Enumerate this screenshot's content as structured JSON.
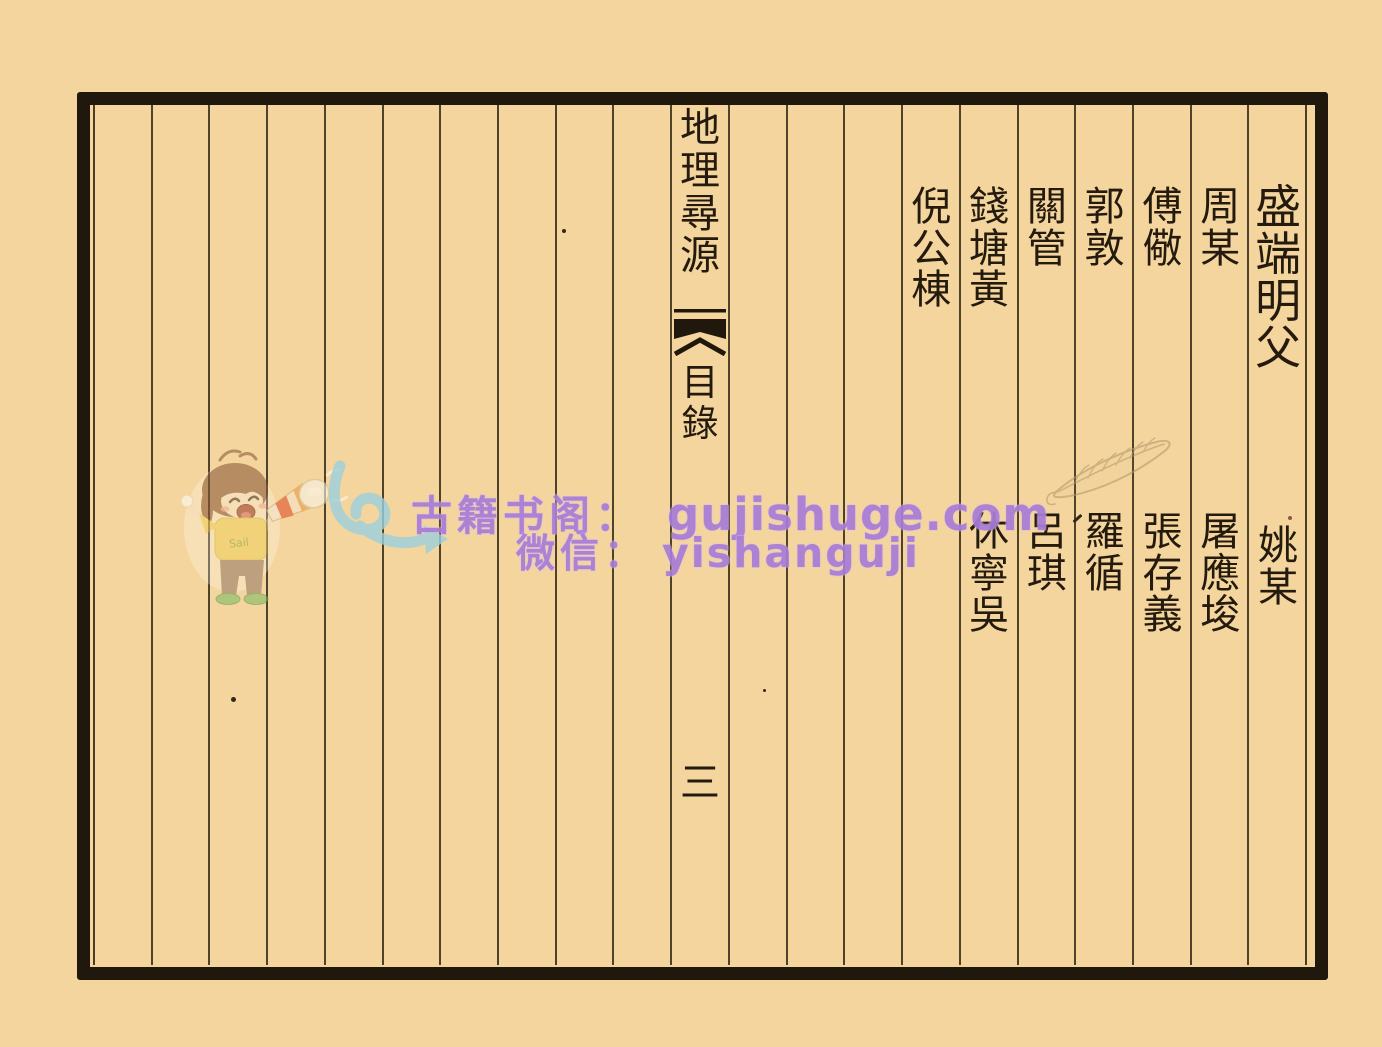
{
  "page_scan": {
    "background_color": "#f4d59d",
    "ink_color": "#241b0e",
    "total_columns": 21,
    "spine": {
      "title": "地理尋源",
      "section_label": "目錄",
      "page_number": "三"
    },
    "name_columns": [
      {
        "position_from_right": 1,
        "top_name": "盛端明父",
        "bottom_name": "姚某"
      },
      {
        "position_from_right": 2,
        "top_name": "周某",
        "bottom_name": "屠應埈"
      },
      {
        "position_from_right": 3,
        "top_name": "傅儆",
        "bottom_name": "張存義"
      },
      {
        "position_from_right": 4,
        "top_name": "郭敦",
        "bottom_name": "羅循"
      },
      {
        "position_from_right": 5,
        "top_name": "關管",
        "bottom_name": "呂琪"
      },
      {
        "position_from_right": 6,
        "top_name": "錢塘黃",
        "bottom_name": "休寧吳"
      },
      {
        "position_from_right": 7,
        "top_name": "倪公棟",
        "bottom_name": ""
      }
    ]
  },
  "watermark": {
    "site_label": "古籍书阁：",
    "site_url": "gujishuge.com",
    "wechat_label": "微信：",
    "wechat_id": "yishanguji",
    "text_color": "#a87cd8",
    "mascot_shirt_text": "Sail"
  }
}
